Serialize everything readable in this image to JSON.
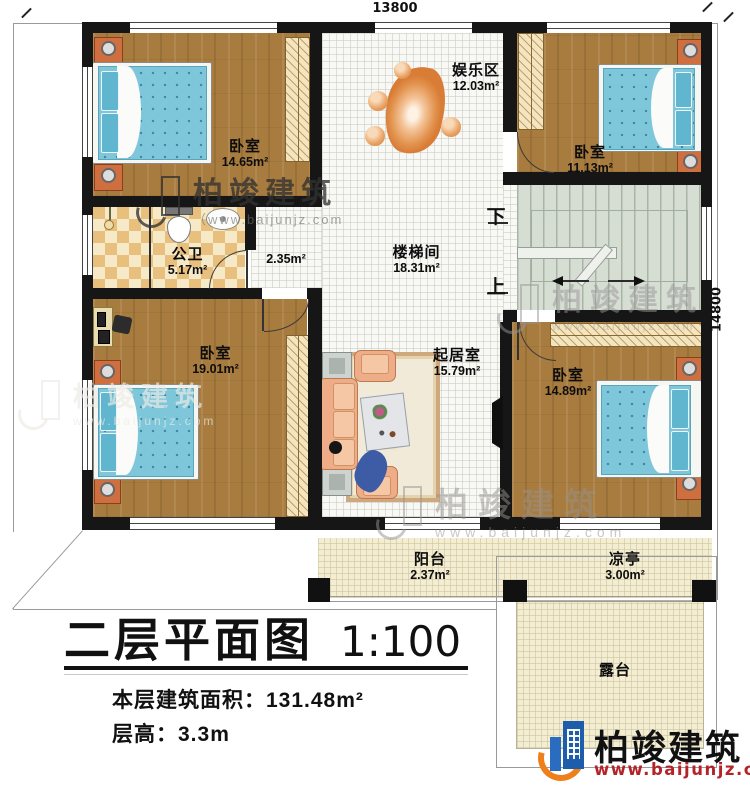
{
  "dimensions": {
    "width_top": "13800",
    "height_right": "14800"
  },
  "rooms": {
    "bedroom_tl": {
      "name": "卧室",
      "area": "14.65m²"
    },
    "bedroom_tr": {
      "name": "卧室",
      "area": "11.13m²"
    },
    "bedroom_bl": {
      "name": "卧室",
      "area": "19.01m²"
    },
    "bedroom_br": {
      "name": "卧室",
      "area": "14.89m²"
    },
    "entertainment": {
      "name": "娱乐区",
      "area": "12.03m²"
    },
    "bathroom": {
      "name": "公卫",
      "area": "5.17m²"
    },
    "hallway": {
      "area": "2.35m²"
    },
    "stairwell": {
      "name": "楼梯间",
      "area": "18.31m²"
    },
    "living_room": {
      "name": "起居室",
      "area": "15.79m²"
    },
    "balcony": {
      "name": "阳台",
      "area": "2.37m²"
    },
    "pavilion": {
      "name": "凉亭",
      "area": "3.00m²"
    },
    "terrace": {
      "name": "露台"
    }
  },
  "stairs": {
    "down_label": "下",
    "up_label": "上"
  },
  "title_block": {
    "title": "二层平面图",
    "scale": "1:100",
    "floor_area": "本层建筑面积：131.48m²",
    "floor_height": "层高：3.3m"
  },
  "brand": {
    "name": "柏竣建筑",
    "website": "www.baijunjz.com"
  },
  "watermark": {
    "name": "柏竣建筑",
    "website": "www.baijunjz.com",
    "website_paren": "（www.baijunjz.com"
  }
}
